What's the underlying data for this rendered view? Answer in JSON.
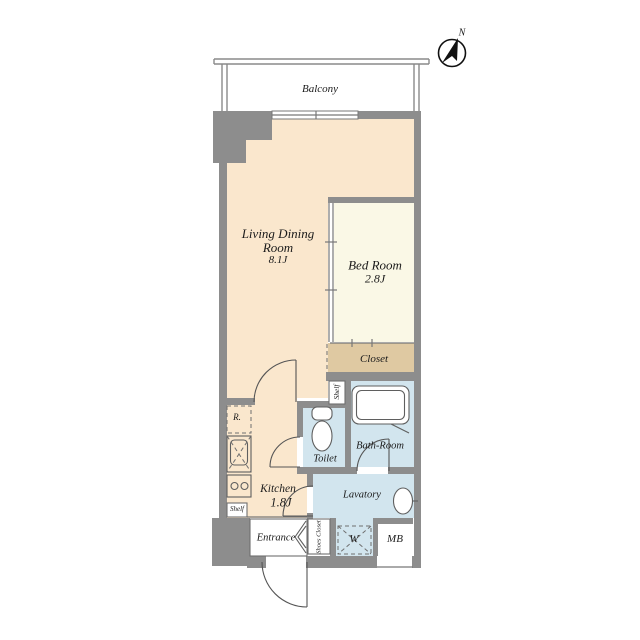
{
  "compass": {
    "north_label": "N"
  },
  "balcony": {
    "label": "Balcony"
  },
  "rooms": {
    "living_dining": {
      "name_line1": "Living Dining",
      "name_line2": "Room",
      "area": "8.1J"
    },
    "bed_room": {
      "name": "Bed Room",
      "area": "2.8J"
    },
    "closet": {
      "name": "Closet"
    },
    "kitchen": {
      "name": "Kitchen",
      "area": "1.8J"
    },
    "toilet": {
      "name": "Toilet"
    },
    "bath_room": {
      "name": "Bath-Room"
    },
    "lavatory": {
      "name": "Lavatory"
    },
    "entrance": {
      "name": "Entrance"
    },
    "shoes_closet": {
      "name": "Shoes Closet"
    },
    "washing_machine": {
      "label": "W"
    },
    "meter_box": {
      "label": "MB"
    },
    "refrigerator": {
      "label": "R."
    },
    "shelf_bath": {
      "label": "Shelf"
    },
    "shelf_kitchen": {
      "label": "Shelf"
    }
  },
  "colors": {
    "wall": "#8D8D8D",
    "floor_main": "#FAE7CD",
    "floor_bedroom": "#FAF8E6",
    "floor_closet": "#DFC9A2",
    "floor_wet": "#D2E5EE",
    "outline": "#777777"
  }
}
